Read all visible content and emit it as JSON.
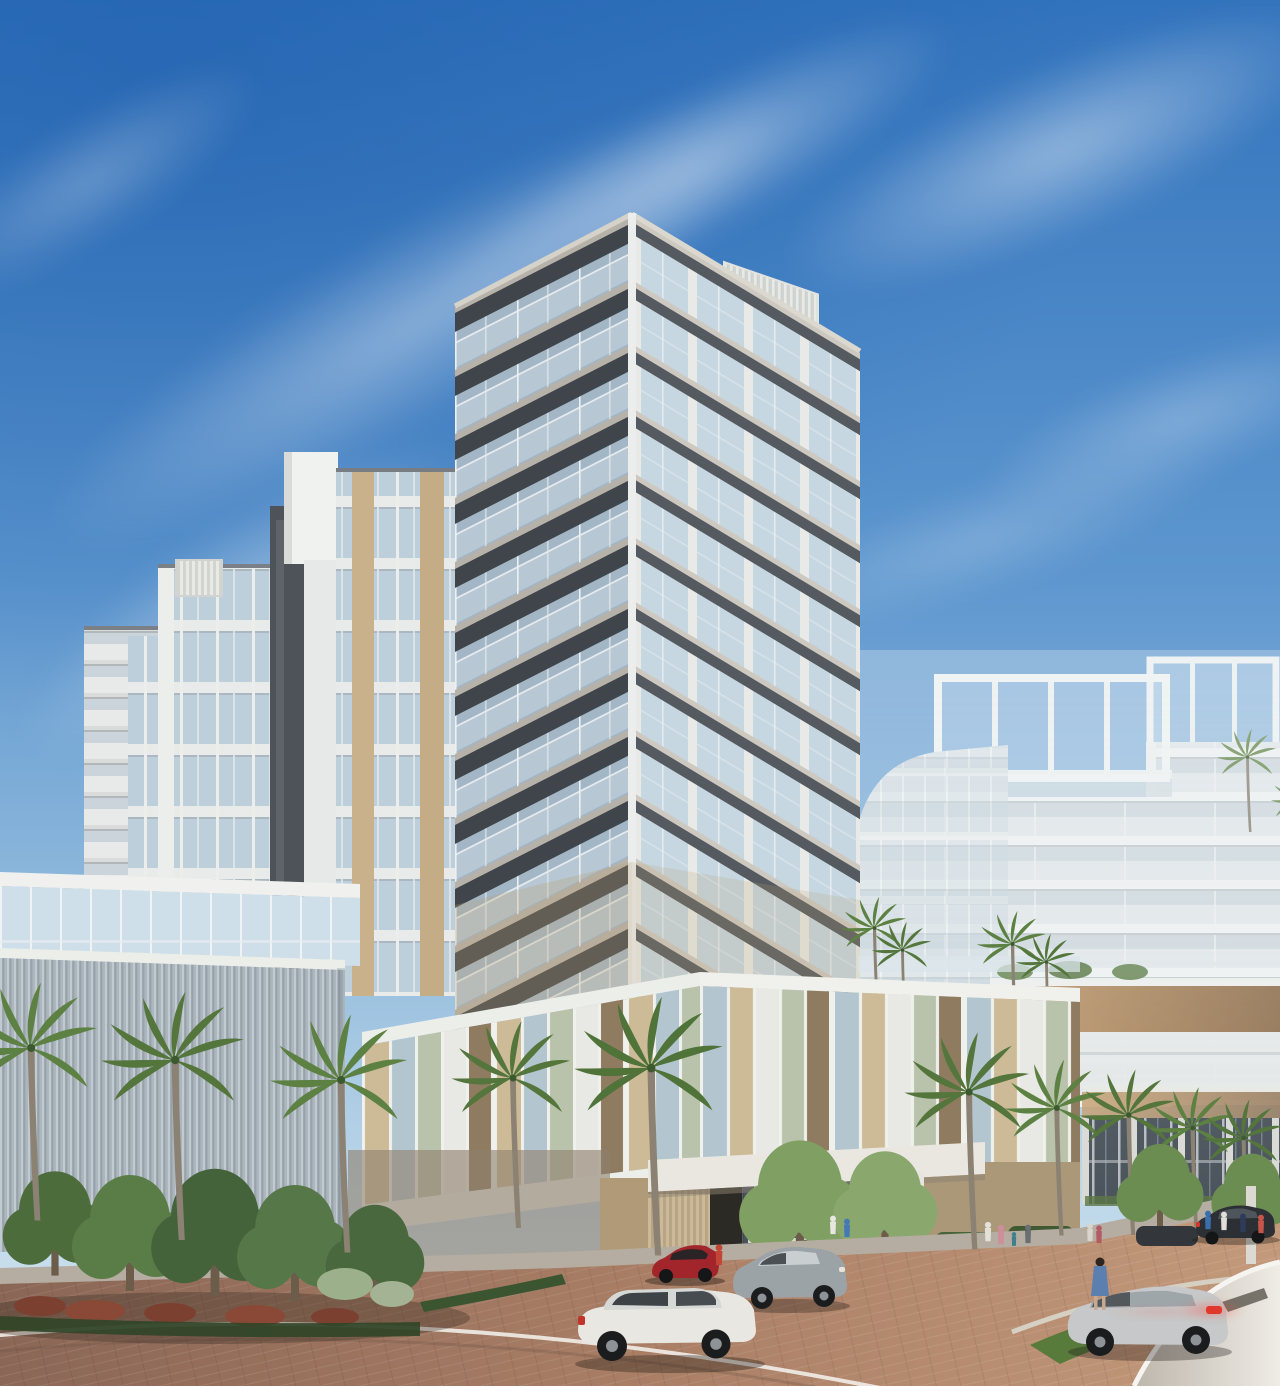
{
  "scene": {
    "type": "architectural-rendering",
    "subject": "modern coastal condominium tower with wraparound glass balconies",
    "setting": "palm-lined street with porte-cochere entrance, neighboring mid-rise buildings, cars and pedestrians",
    "sky": "clear blue with diagonal wispy clouds",
    "lighting": "warm late-afternoon sun from the right"
  },
  "palette": {
    "sky-top": "#3273bd",
    "sky-mid": "#5e97cf",
    "sky-low": "#9ec3e0",
    "sky-horizon": "#d9e9f2",
    "cloud": "#ffffff",
    "slab-light": "#cdc9c1",
    "slab-dark": "#40454b",
    "soffit": "#3c4046",
    "tower-glass": "#c6d7e2",
    "balcony-glass": "#a3b6c6",
    "column-white": "#e9eae7",
    "left-facade": "#e7eae9",
    "left-pier-dark": "#4d5359",
    "tan-panel": "#c9b28b",
    "louver-light": "#c1cad0",
    "louver-dark": "#98a2aa",
    "fin-beige": "#cdbb98",
    "fin-blue": "#b3c6d0",
    "fin-sage": "#b9c3ab",
    "fin-bronze": "#8f7c60",
    "fin-white": "#e8e9e4",
    "wall-tan": "#b09a78",
    "wood-band": "#c59c6b",
    "storefront-glass": "#434c54",
    "bg-building": "#e3e8ea",
    "bg-fascia": "#f0f2f1",
    "sidewalk": "#b5ada1",
    "road-dark": "#8a6656",
    "road-mid": "#a97e65",
    "road-light": "#c49a7c",
    "curb": "#d8d0c2",
    "grass": "#587a3b",
    "hedge": "#3f5a33",
    "tree-green": "#4d6c3c",
    "tree-light": "#7f9f63",
    "palm-frond": "#54763d",
    "palm-trunk": "#8c8273",
    "shrub-red": "#8a4936",
    "shrub-pale": "#9db08c",
    "canopy": "#e4ded5",
    "canopy-edge": "#f6f4f0",
    "car-white": "#e9e7e2",
    "car-silver": "#9ba3a7",
    "car-red": "#a2252b",
    "car-gray": "#c6c8c9",
    "car-dark": "#2c2f33",
    "taillight": "#d5352c"
  },
  "buildings": {
    "main_tower": {
      "balcony_floors": 11,
      "style": "wraparound balconies, dark slab edges, glass railings, white corner columns",
      "rooftop": "white louvered mechanical screen"
    },
    "left_midrise": {
      "floors": 12,
      "style": "white grid facade, dark piers, tan spandrel panels, edge balconies",
      "rooftop": "white screens"
    },
    "right_midrise": {
      "floors": 9,
      "style": "white horizontal balconies, rooftop trellis frame, curved glass corner"
    },
    "far_right_midrise": {
      "floors": 9,
      "style": "white facade with rooftop frame"
    },
    "podium": {
      "fin_colors": [
        "beige",
        "blue-gray",
        "sage",
        "white",
        "bronze"
      ],
      "ground": "tan walls, garage portal, glass lobby, hedge planters"
    },
    "amenity_wing": {
      "style": "vertical corrugated louver cladding with glass band above"
    }
  },
  "street": {
    "vehicles": [
      {
        "type": "suv",
        "color": "white",
        "position": "bottom-left, driving"
      },
      {
        "type": "suv",
        "color": "silver",
        "position": "center, driving"
      },
      {
        "type": "sports-car",
        "color": "red",
        "position": "under porte-cochere"
      },
      {
        "type": "suv",
        "color": "light-gray",
        "position": "bottom-right, braking"
      },
      {
        "type": "sedan",
        "color": "dark",
        "position": "right, parked"
      },
      {
        "type": "sedan",
        "color": "dark-gray",
        "position": "behind right suv"
      }
    ],
    "pedestrians_count": 14,
    "palm_trees_count": 16,
    "surface": "herringbone pavers with curved curb arcs and grass median"
  }
}
